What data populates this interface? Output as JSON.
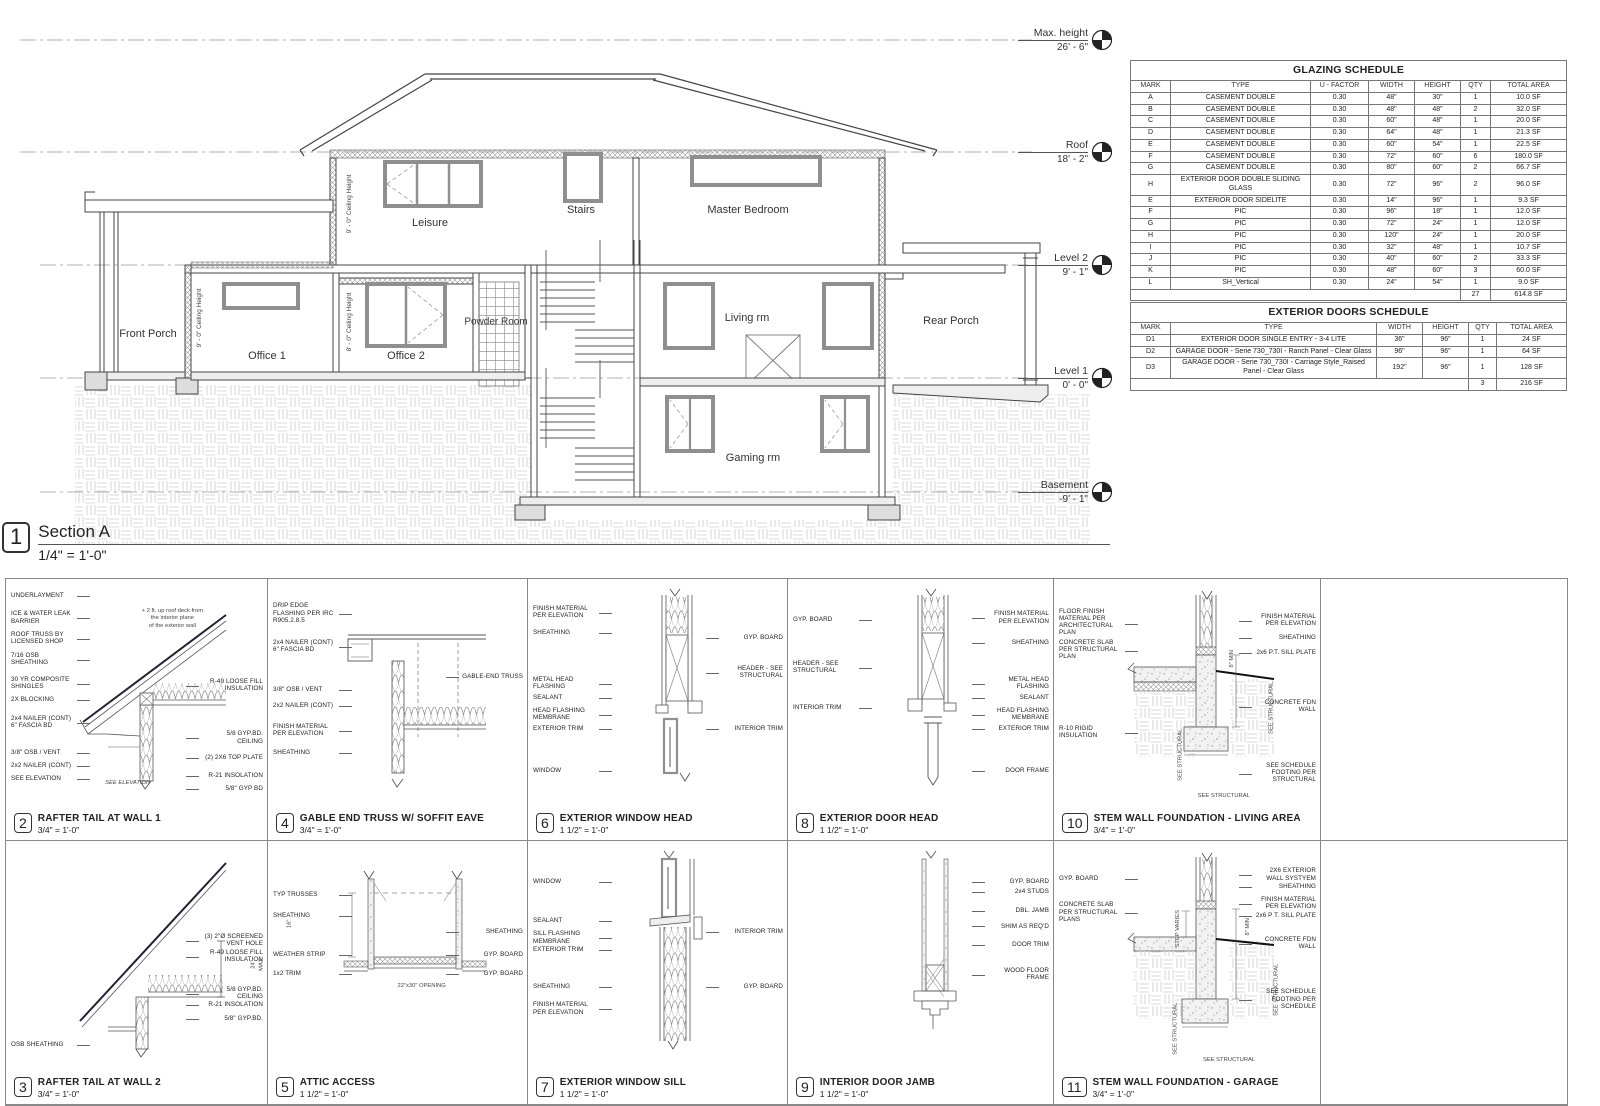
{
  "section": {
    "number": "1",
    "title": "Section A",
    "scale": "1/4\" = 1'-0\"",
    "rooms": [
      {
        "label": "Front Porch",
        "x": 148,
        "y": 334,
        "size": "n"
      },
      {
        "label": "Office 1",
        "x": 267,
        "y": 356,
        "size": "n"
      },
      {
        "label": "Office 2",
        "x": 406,
        "y": 356,
        "size": "n"
      },
      {
        "label": "Powder Room",
        "x": 496,
        "y": 322,
        "size": "s"
      },
      {
        "label": "Leisure",
        "x": 430,
        "y": 223,
        "size": "n"
      },
      {
        "label": "Stairs",
        "x": 581,
        "y": 210,
        "size": "n"
      },
      {
        "label": "Master Bedroom",
        "x": 748,
        "y": 210,
        "size": "n"
      },
      {
        "label": "Living rm",
        "x": 747,
        "y": 318,
        "size": "n"
      },
      {
        "label": "Rear Porch",
        "x": 951,
        "y": 321,
        "size": "n"
      },
      {
        "label": "Gaming rm",
        "x": 753,
        "y": 458,
        "size": "n"
      }
    ],
    "ceiling_heights": [
      {
        "dim": "9' - 0\"",
        "label": "Ceiling Height",
        "x": 350,
        "y": 204
      },
      {
        "dim": "9' - 0\"",
        "label": "Ceiling Height",
        "x": 200,
        "y": 318
      },
      {
        "dim": "8' - 0\"",
        "label": "Ceiling Height",
        "x": 350,
        "y": 322
      }
    ],
    "levels": [
      {
        "name": "Max. height",
        "elev": "26' - 6\"",
        "y": 40
      },
      {
        "name": "Roof",
        "elev": "18' - 2\"",
        "y": 152
      },
      {
        "name": "Level 2",
        "elev": "9' - 1\"",
        "y": 265
      },
      {
        "name": "Level 1",
        "elev": "0' - 0\"",
        "y": 378
      },
      {
        "name": "Basement",
        "elev": "-9' - 1\"",
        "y": 492
      }
    ]
  },
  "glazing_schedule": {
    "title": "GLAZING SCHEDULE",
    "columns": [
      "MARK",
      "TYPE",
      "U - FACTOR",
      "WIDTH",
      "HEIGHT",
      "QTY",
      "TOTAL AREA"
    ],
    "rows": [
      [
        "A",
        "CASEMENT DOUBLE",
        "0.30",
        "48\"",
        "30\"",
        "1",
        "10.0 SF"
      ],
      [
        "B",
        "CASEMENT DOUBLE",
        "0.30",
        "48\"",
        "48\"",
        "2",
        "32.0 SF"
      ],
      [
        "C",
        "CASEMENT DOUBLE",
        "0.30",
        "60\"",
        "48\"",
        "1",
        "20.0 SF"
      ],
      [
        "D",
        "CASEMENT DOUBLE",
        "0.30",
        "64\"",
        "48\"",
        "1",
        "21.3 SF"
      ],
      [
        "E",
        "CASEMENT DOUBLE",
        "0.30",
        "60\"",
        "54\"",
        "1",
        "22.5 SF"
      ],
      [
        "F",
        "CASEMENT DOUBLE",
        "0.30",
        "72\"",
        "60\"",
        "6",
        "180.0 SF"
      ],
      [
        "G",
        "CASEMENT DOUBLE",
        "0.30",
        "80\"",
        "60\"",
        "2",
        "66.7 SF"
      ],
      [
        "H",
        "EXTERIOR DOOR DOUBLE SLIDING GLASS",
        "0.30",
        "72\"",
        "96\"",
        "2",
        "96.0 SF"
      ],
      [
        "E",
        "EXTERIOR DOOR SIDELITE",
        "0.30",
        "14\"",
        "96\"",
        "1",
        "9.3 SF"
      ],
      [
        "F",
        "PIC",
        "0.30",
        "96\"",
        "18\"",
        "1",
        "12.0 SF"
      ],
      [
        "G",
        "PIC",
        "0.30",
        "72\"",
        "24\"",
        "1",
        "12.0 SF"
      ],
      [
        "H",
        "PIC",
        "0.30",
        "120\"",
        "24\"",
        "1",
        "20.0 SF"
      ],
      [
        "I",
        "PIC",
        "0.30",
        "32\"",
        "48\"",
        "1",
        "10.7 SF"
      ],
      [
        "J",
        "PIC",
        "0.30",
        "40\"",
        "60\"",
        "2",
        "33.3 SF"
      ],
      [
        "K",
        "PIC",
        "0.30",
        "48\"",
        "60\"",
        "3",
        "60.0 SF"
      ],
      [
        "L",
        "SH_Vertical",
        "0.30",
        "24\"",
        "54\"",
        "1",
        "9.0 SF"
      ]
    ],
    "total_qty": "27",
    "total_area": "614.8 SF"
  },
  "doors_schedule": {
    "title": "EXTERIOR DOORS SCHEDULE",
    "columns": [
      "MARK",
      "TYPE",
      "WIDTH",
      "HEIGHT",
      "QTY",
      "TOTAL AREA"
    ],
    "rows": [
      [
        "D1",
        "EXTERIOR DOOR SINGLE ENTRY - 3-4 LITE",
        "36\"",
        "96\"",
        "1",
        "24 SF"
      ],
      [
        "D2",
        "GARAGE DOOR - Serie 730_730I - Ranch Panel - Clear Glass",
        "96\"",
        "96\"",
        "1",
        "64 SF"
      ],
      [
        "D3",
        "GARAGE DOOR - Serie 730_730I - Carriage Style_Raised Panel - Clear Glass",
        "192\"",
        "96\"",
        "1",
        "128 SF"
      ]
    ],
    "total_qty": "3",
    "total_area": "216 SF"
  },
  "details": [
    {
      "number": "2",
      "title": "RAFTER TAIL AT WALL 1",
      "scale": "3/4\" = 1'-0\"",
      "sketch": "rafter1",
      "row": 0,
      "col": 0,
      "labels_left": [
        {
          "t": "UNDERLAYMENT",
          "y": 5
        },
        {
          "t": "ICE & WATER LEAK BARRIER",
          "y": 12
        },
        {
          "t": "ROOF TRUSS BY LICENSED SHOP",
          "y": 20
        },
        {
          "t": "7/16 OSB SHEATHING",
          "y": 28
        },
        {
          "t": "30 YR COMPOSITE SHINGLES",
          "y": 37
        },
        {
          "t": "2X BLOCKING",
          "y": 45
        },
        {
          "t": "2x4 NAILER (CONT) 6\" FASCIA BD",
          "y": 52
        },
        {
          "t": "3/8\" OSB / VENT",
          "y": 65
        },
        {
          "t": "2x2 NAILER (CONT)",
          "y": 70
        },
        {
          "t": "SEE ELEVATION",
          "y": 75
        }
      ],
      "labels_right": [
        {
          "t": "R-49 LOOSE FILL INSULATION",
          "y": 38
        },
        {
          "t": "5/8 GYP.BD. CEILING",
          "y": 58
        },
        {
          "t": "(2) 2X6 TOP PLATE",
          "y": 67
        },
        {
          "t": "R-21 INSOLATION",
          "y": 74
        },
        {
          "t": "5/8\" GYP BD",
          "y": 79
        }
      ],
      "extras": [
        {
          "t": "+ 2 ft. up roof deck from\nthe interior plane\nof the exterior wall",
          "x": 52,
          "y": 11
        },
        {
          "t": "SEE ELEVATION",
          "x": 38,
          "y": 77,
          "it": true
        }
      ]
    },
    {
      "number": "4",
      "title": "GABLE END TRUSS W/ SOFFIT EAVE",
      "scale": "3/4\" = 1'-0\"",
      "sketch": "gable",
      "row": 0,
      "col": 1,
      "labels_left": [
        {
          "t": "DRIP EDGE FLASHING PER IRC R905.2.8.5",
          "y": 9
        },
        {
          "t": "2x4 NAILER (CONT) 6\" FASCIA BD",
          "y": 23
        },
        {
          "t": "3/8\" OSB / VENT",
          "y": 41
        },
        {
          "t": "2x2 NAILER (CONT)",
          "y": 47
        },
        {
          "t": "FINISH MATERIAL PER ELEVATION",
          "y": 55
        },
        {
          "t": "SHEATHING",
          "y": 65
        }
      ],
      "labels_right": [
        {
          "t": "GABLE-END TRUSS",
          "y": 36
        }
      ],
      "extras": []
    },
    {
      "number": "6",
      "title": "EXTERIOR WINDOW HEAD",
      "scale": "1 1/2\" = 1'-0\"",
      "sketch": "head",
      "row": 0,
      "col": 2,
      "labels_left": [
        {
          "t": "FINISH MATERIAL PER ELEVATION",
          "y": 10
        },
        {
          "t": "SHEATHING",
          "y": 19
        },
        {
          "t": "METAL HEAD FLASHING",
          "y": 37
        },
        {
          "t": "SEALANT",
          "y": 44
        },
        {
          "t": "HEAD FLASHING MEMBRANE",
          "y": 49
        },
        {
          "t": "EXTERIOR TRIM",
          "y": 56
        },
        {
          "t": "WINDOW",
          "y": 72
        }
      ],
      "labels_right": [
        {
          "t": "GYP. BOARD",
          "y": 21
        },
        {
          "t": "HEADER - SEE STRUCTURAL",
          "y": 33
        },
        {
          "t": "INTERIOR TRIM",
          "y": 56
        }
      ],
      "extras": []
    },
    {
      "number": "8",
      "title": "EXTERIOR DOOR HEAD",
      "scale": "1 1/2\" = 1'-0\"",
      "sketch": "doorhead",
      "row": 0,
      "col": 3,
      "labels_left": [
        {
          "t": "GYP. BOARD",
          "y": 14
        },
        {
          "t": "HEADER - SEE STRUCTURAL",
          "y": 31
        },
        {
          "t": "INTERIOR TRIM",
          "y": 48
        }
      ],
      "labels_right": [
        {
          "t": "FINISH MATERIAL PER ELEVATION",
          "y": 12
        },
        {
          "t": "SHEATHING",
          "y": 23
        },
        {
          "t": "METAL HEAD FLASHING",
          "y": 37
        },
        {
          "t": "SEALANT",
          "y": 44
        },
        {
          "t": "HEAD FLASHING MEMBRANE",
          "y": 49
        },
        {
          "t": "EXTERIOR TRIM",
          "y": 56
        },
        {
          "t": "DOOR FRAME",
          "y": 72
        }
      ],
      "extras": []
    },
    {
      "number": "10",
      "title": "STEM WALL FOUNDATION - LIVING AREA",
      "scale": "3/4\" = 1'-0\"",
      "sketch": "stemwall",
      "row": 0,
      "col": 4,
      "labels_left": [
        {
          "t": "FLOOR FINISH MATERIAL PER ARCHITECTURAL PLAN",
          "y": 11
        },
        {
          "t": "CONCRETE SLAB PER STRUCTURAL PLAN",
          "y": 23
        },
        {
          "t": "R-10 RIGID INSULATION",
          "y": 56
        }
      ],
      "labels_right": [
        {
          "t": "FINISH MATERIAL PER ELEVATION",
          "y": 13
        },
        {
          "t": "SHEATHING",
          "y": 21
        },
        {
          "t": "2x6 P.T. SILL PLATE",
          "y": 27
        },
        {
          "t": "CONCRETE FDN WALL",
          "y": 46
        },
        {
          "t": "SEE SCHEDULE FOOTING PER STRUCTURAL",
          "y": 70
        }
      ],
      "extras": [
        {
          "t": "SEE STRUCTURAL",
          "x": 72,
          "y": 48,
          "rot": true
        },
        {
          "t": "8\" MIN",
          "x": 64,
          "y": 29,
          "rot": true
        },
        {
          "t": "SEE STRUCTURAL",
          "x": 38,
          "y": 66,
          "rot": true
        },
        {
          "t": "SEE STRUCTURAL",
          "x": 54,
          "y": 82
        }
      ]
    },
    {
      "number": "3",
      "title": "RAFTER TAIL AT WALL 2",
      "scale": "3/4\" = 1'-0\"",
      "sketch": "rafter2",
      "row": 1,
      "col": 0,
      "labels_left": [
        {
          "t": "OSB SHEATHING",
          "y": 76
        }
      ],
      "labels_right": [
        {
          "t": "(3) 2\"Ø SCREENED VENT HOLE",
          "y": 35
        },
        {
          "t": "R-49 LOOSE FILL INSULATION",
          "y": 41
        },
        {
          "t": "5/8 GYP.BD. CEILING",
          "y": 55
        },
        {
          "t": "R-21 INSOLATION",
          "y": 61
        },
        {
          "t": "5/8\" GYP.BD.",
          "y": 66
        }
      ],
      "extras": [
        {
          "t": "24\" MAX",
          "x": 93,
          "y": 44,
          "rot": true
        }
      ]
    },
    {
      "number": "5",
      "title": "ATTIC ACCESS",
      "scale": "1 1/2\" = 1'-0\"",
      "sketch": "attic",
      "row": 1,
      "col": 1,
      "labels_left": [
        {
          "t": "TYP TRUSSES",
          "y": 19
        },
        {
          "t": "SHEATHING",
          "y": 27
        },
        {
          "t": "WEATHER STRIP",
          "y": 42
        },
        {
          "t": "1x2 TRIM",
          "y": 49
        }
      ],
      "labels_right": [
        {
          "t": "SHEATHING",
          "y": 33
        },
        {
          "t": "GYP. BOARD",
          "y": 42
        },
        {
          "t": "GYP. BOARD",
          "y": 49
        }
      ],
      "extras": [
        {
          "t": "22\"x30\" OPENING",
          "x": 50,
          "y": 54
        },
        {
          "t": "16\"",
          "x": 7,
          "y": 30,
          "rot": true
        }
      ]
    },
    {
      "number": "7",
      "title": "EXTERIOR WINDOW SILL",
      "scale": "1 1/2\" = 1'-0\"",
      "sketch": "sill",
      "row": 1,
      "col": 2,
      "labels_left": [
        {
          "t": "WINDOW",
          "y": 14
        },
        {
          "t": "SEALANT",
          "y": 29
        },
        {
          "t": "SILL FLASHING MEMBRANE",
          "y": 34
        },
        {
          "t": "EXTERIOR TRIM",
          "y": 40
        },
        {
          "t": "SHEATHING",
          "y": 54
        },
        {
          "t": "FINISH MATERIAL PER ELEVATION",
          "y": 61
        }
      ],
      "labels_right": [
        {
          "t": "INTERIOR TRIM",
          "y": 33
        },
        {
          "t": "GYP. BOARD",
          "y": 54
        }
      ],
      "extras": []
    },
    {
      "number": "9",
      "title": "INTERIOR DOOR JAMB",
      "scale": "1 1/2\" = 1'-0\"",
      "sketch": "jamb",
      "row": 1,
      "col": 3,
      "labels_left": [],
      "labels_right": [
        {
          "t": "GYP. BOARD",
          "y": 14
        },
        {
          "t": "2x4 STUDS",
          "y": 18
        },
        {
          "t": "DBL. JAMB",
          "y": 25
        },
        {
          "t": "SHIM AS REQ'D",
          "y": 31
        },
        {
          "t": "DOOR TRIM",
          "y": 38
        },
        {
          "t": "WOOD FLOOR FRAME",
          "y": 48
        }
      ],
      "extras": []
    },
    {
      "number": "11",
      "title": "STEM WALL FOUNDATION - GARAGE",
      "scale": "3/4\" = 1'-0\"",
      "sketch": "stemwall2",
      "row": 1,
      "col": 4,
      "labels_left": [
        {
          "t": "GYP. BOARD",
          "y": 13
        },
        {
          "t": "CONCRETE SLAB PER STRUCTURAL PLANS",
          "y": 23
        }
      ],
      "labels_right": [
        {
          "t": "2X6 EXTERIOR WALL SYSTYEM",
          "y": 10
        },
        {
          "t": "SHEATHING",
          "y": 16
        },
        {
          "t": "FINISH MATERIAL PER ELEVATION",
          "y": 21
        },
        {
          "t": "2x6 P T. SILL PLATE",
          "y": 27
        },
        {
          "t": "CONCRETE FDN WALL",
          "y": 36
        },
        {
          "t": "SEE SCHEDULE FOOTING PER SCHEDULE",
          "y": 56
        }
      ],
      "extras": [
        {
          "t": "STEP VARIES",
          "x": 40,
          "y": 32,
          "rot": true
        },
        {
          "t": "8\" MIN",
          "x": 70,
          "y": 31,
          "rot": true
        },
        {
          "t": "SEE STRUCTURAL",
          "x": 74,
          "y": 55,
          "rot": true
        },
        {
          "t": "SEE STRUCTURAL",
          "x": 36,
          "y": 70,
          "rot": true
        },
        {
          "t": "SEE STRUCTURAL",
          "x": 56,
          "y": 82
        }
      ]
    }
  ]
}
